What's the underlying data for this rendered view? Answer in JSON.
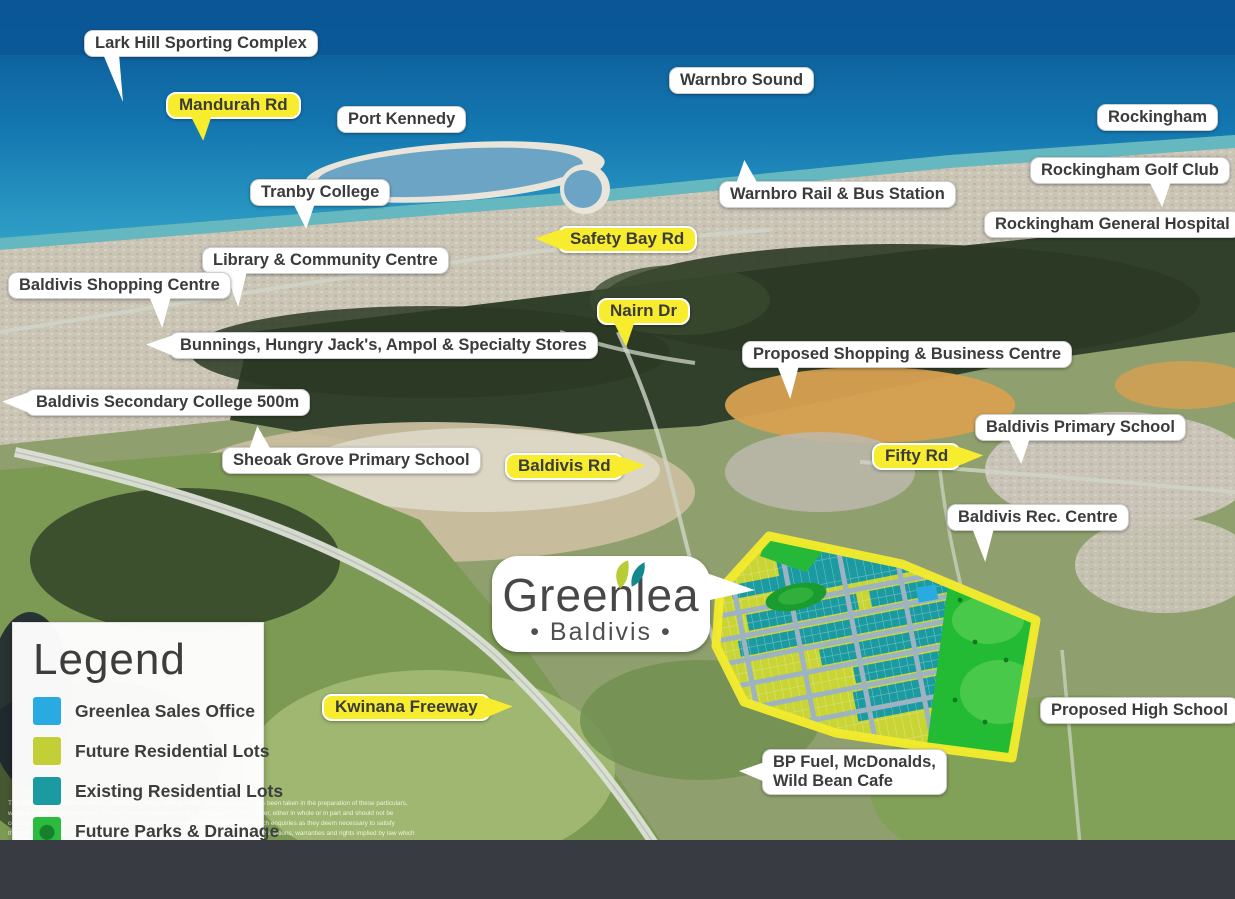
{
  "logo": {
    "name": "Greenlea",
    "tagline": "• Baldivis •"
  },
  "legend": {
    "title": "Legend",
    "items": [
      {
        "label": "Greenlea Sales Office",
        "color": "#29abe2"
      },
      {
        "label": "Future Residential Lots",
        "color": "#c3cf37"
      },
      {
        "label": "Existing Residential Lots",
        "color": "#1b9ba1"
      },
      {
        "label": "Future Parks & Drainage",
        "color": "#2bbb3f"
      }
    ]
  },
  "labels": {
    "places": [
      "Lark Hill Sporting Complex",
      "Port Kennedy",
      "Warnbro Sound",
      "Rockingham",
      "Tranby College",
      "Warnbro Rail & Bus Station",
      "Rockingham Golf Club",
      "Rockingham General Hospital",
      "Library & Community Centre",
      "Baldivis Shopping Centre",
      "Bunnings, Hungry Jack's, Ampol & Specialty Stores",
      "Proposed Shopping  & Business Centre",
      "Baldivis Secondary College 500m",
      "Baldivis Primary School",
      "Sheoak Grove Primary School",
      "Baldivis Rec. Centre",
      "Proposed High School"
    ],
    "bp": [
      "BP Fuel, McDonalds,",
      "Wild Bean Cafe"
    ],
    "roads": [
      "Mandurah Rd",
      "Safety Bay Rd",
      "Nairn Dr",
      "Baldivis Rd",
      "Fifty Rd",
      "Kwinana Freeway"
    ]
  },
  "disclaimer": "The information contained herein is subject to change without notice. Whilst every care has been taken in the preparation of these particulars, which are believed to be correct, it is not to be nor intended by the selling agent or the owner, either in whole or in part and should not be construed as forming part of any contract. Prospective purchasers are advised to make such enquiries as they deem necessary to satisfy themselves on all matters in this regard. This statement applies except in respect of those conditions, warranties and rights implied by law which cannot be excluded or modified.",
  "colors": {
    "road_label_bg": "#f7ed2e",
    "label_text": "#3b3b3b",
    "estate_border": "#f2ea2d",
    "estate_future_lots": "#c9d435",
    "estate_existing_lots": "#1b9ba1",
    "estate_parks": "#22bb33",
    "estate_sales_office": "#29abe2",
    "bottom_bar": "#383b41"
  }
}
